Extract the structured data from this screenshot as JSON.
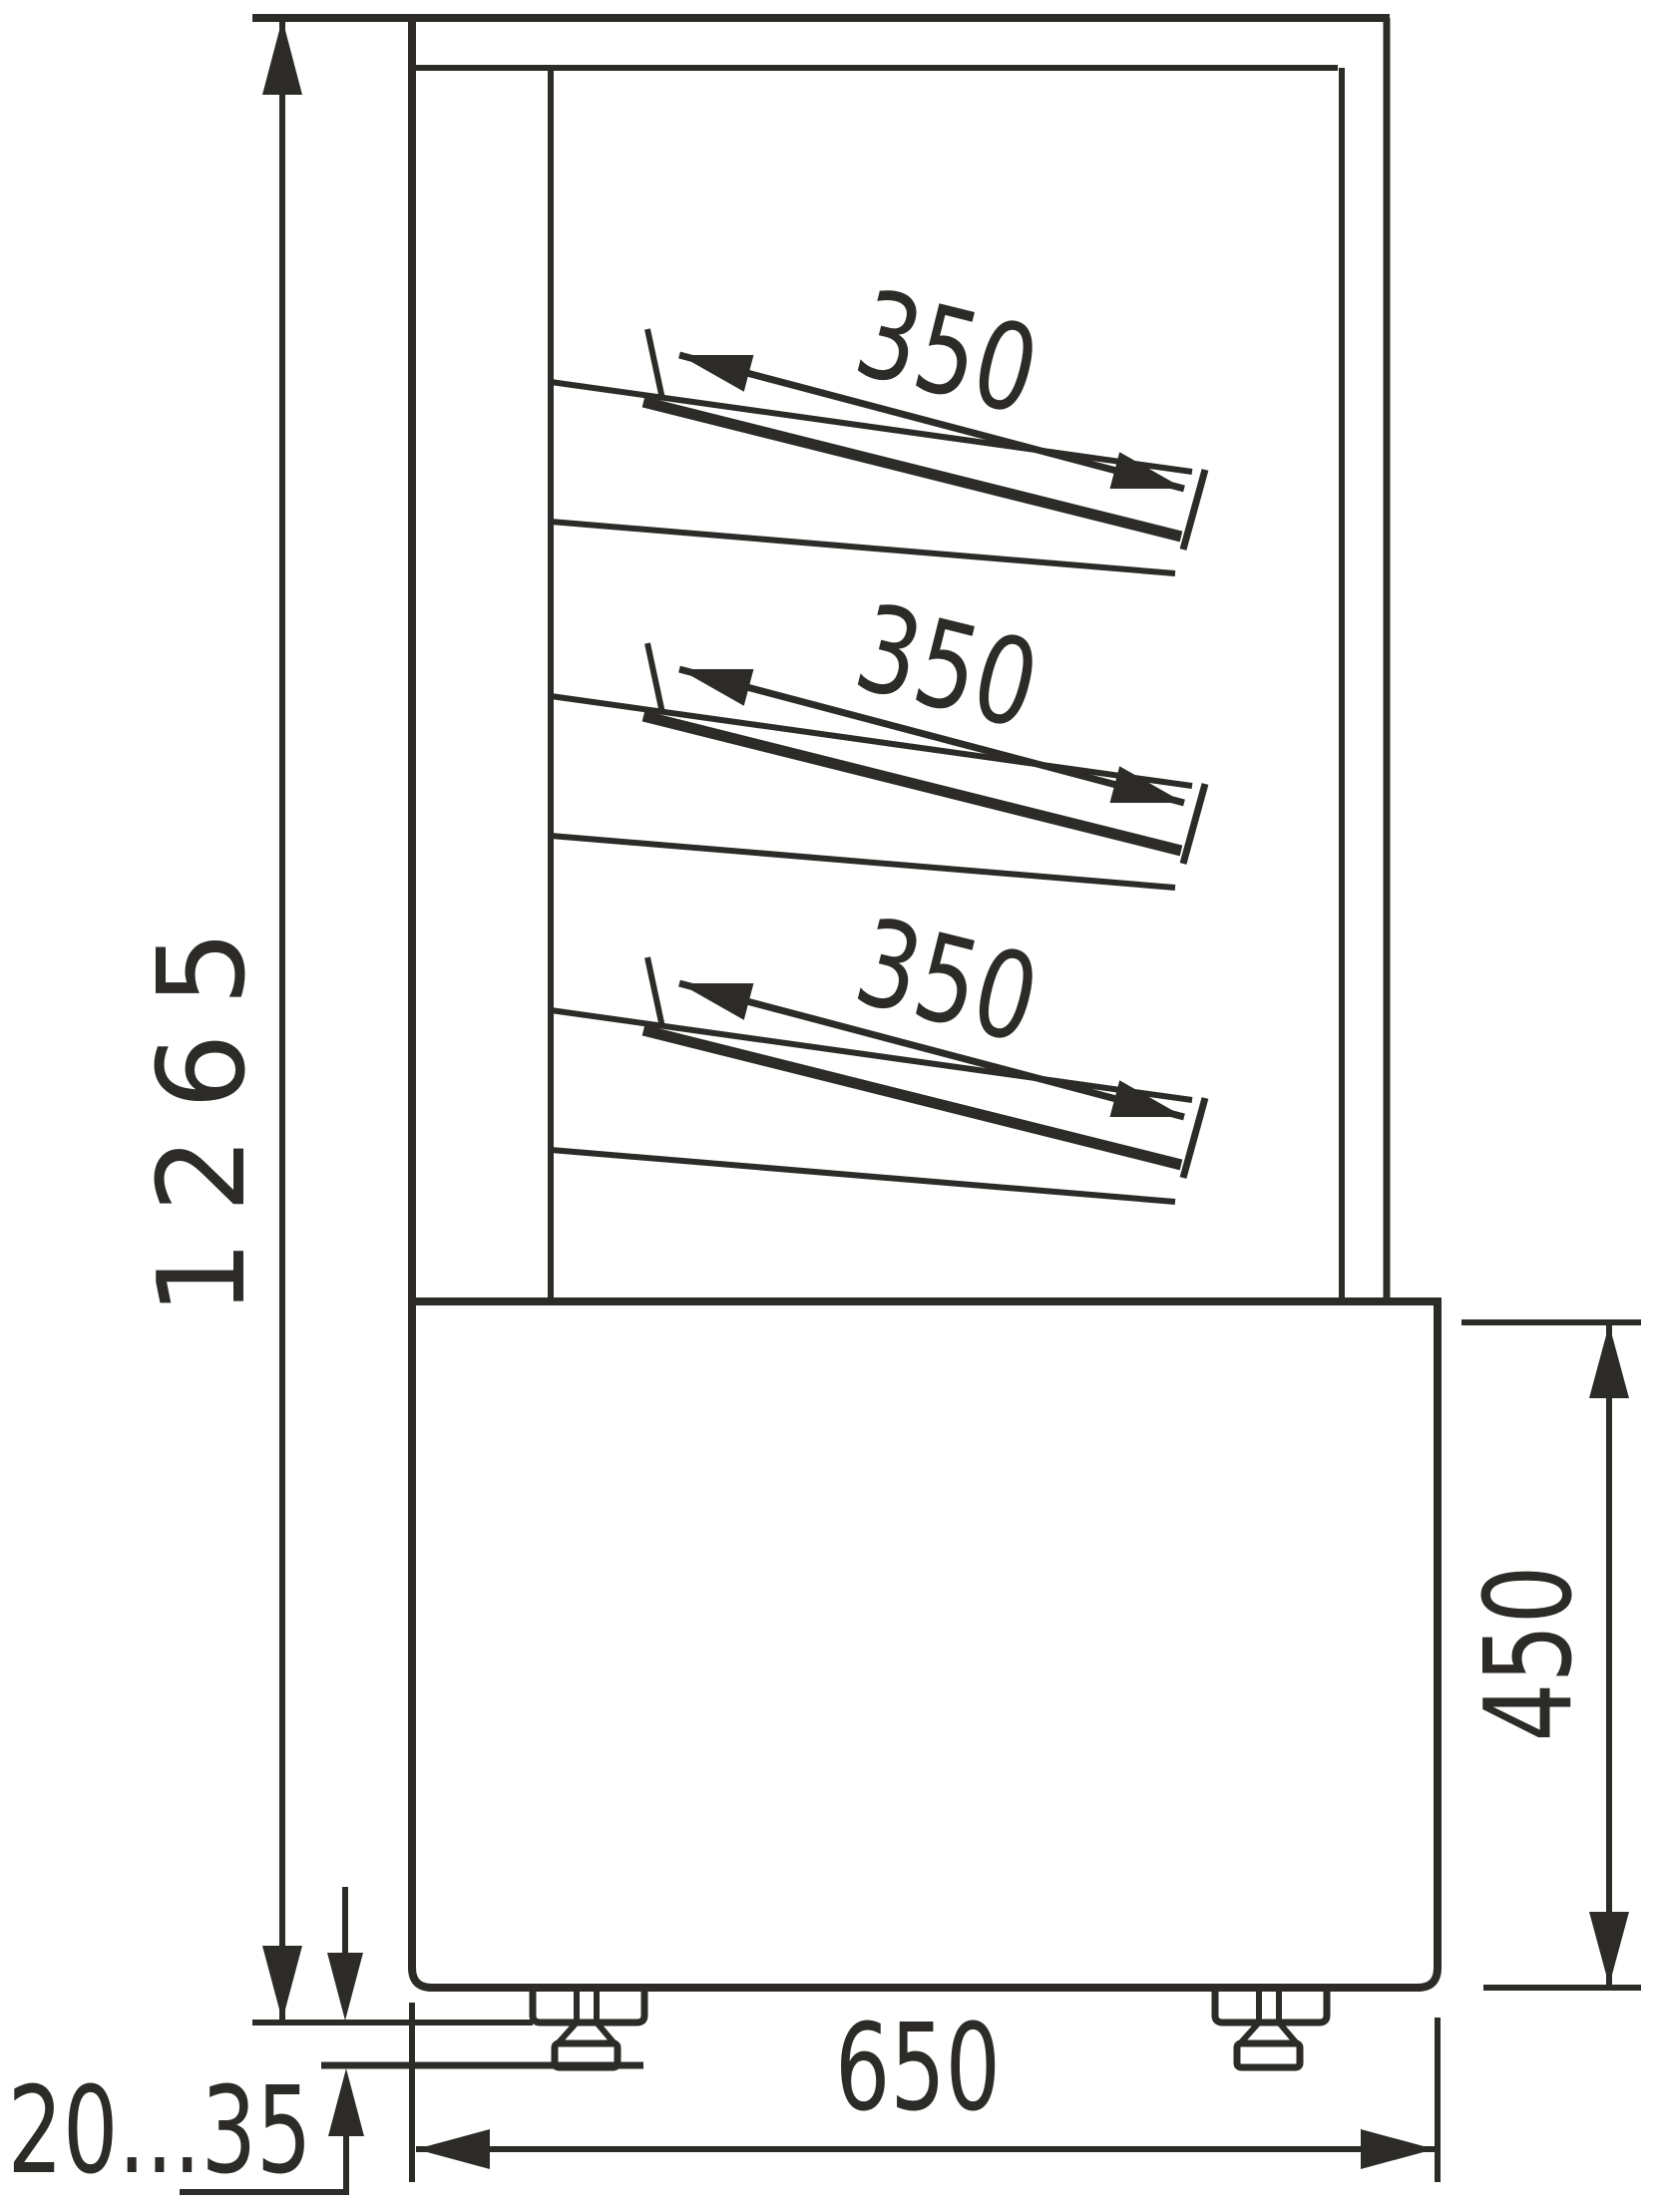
{
  "drawing": {
    "kind": "technical-dimension-drawing",
    "view": "side-section-of-display-case",
    "colors": {
      "line": "#2d2b28",
      "background": "#ffffff"
    },
    "labels": {
      "overall_height": "1265",
      "base_height": "450",
      "base_depth": "650",
      "foot_height_range": "20...35"
    },
    "shelves": [
      {
        "depth": "350"
      },
      {
        "depth": "350"
      },
      {
        "depth": "350"
      }
    ]
  }
}
